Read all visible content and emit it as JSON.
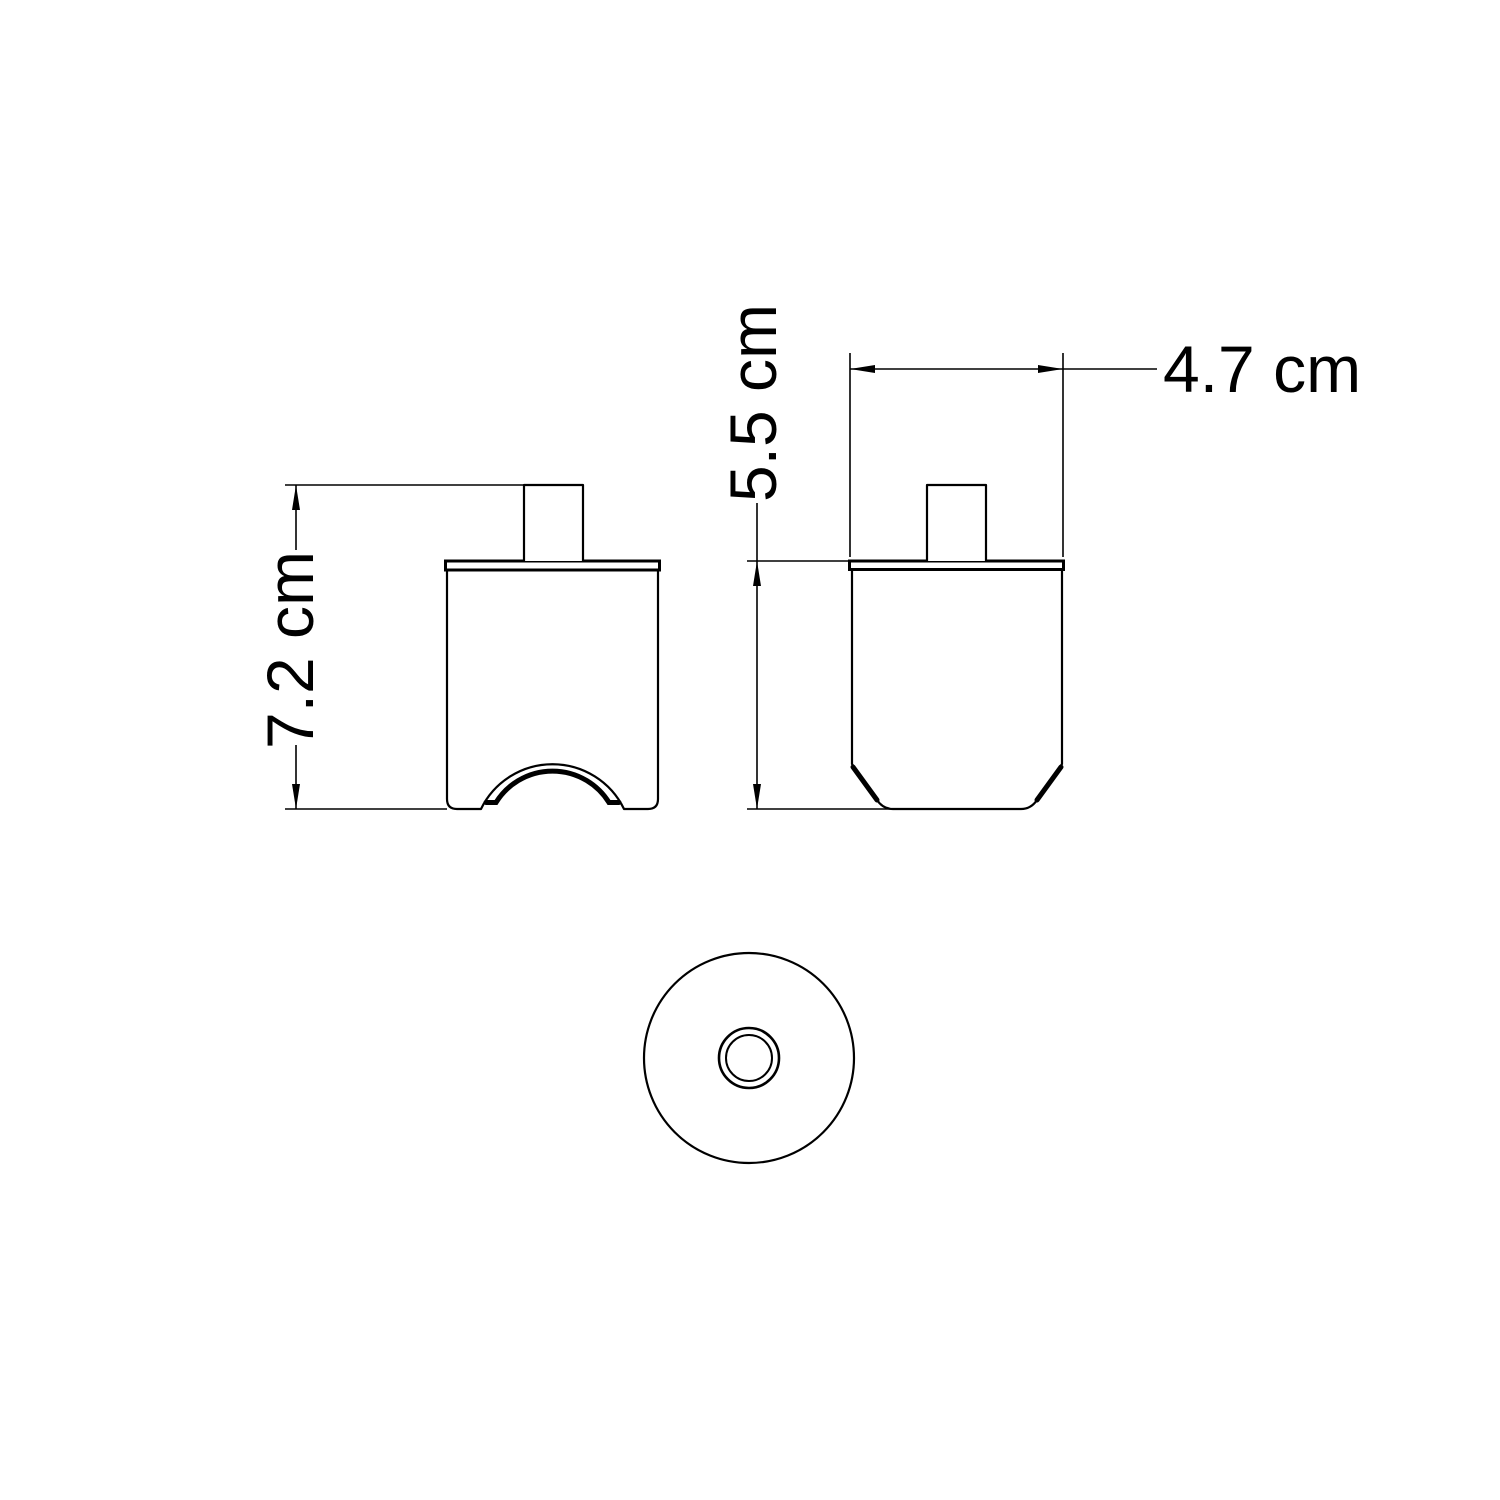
{
  "drawing": {
    "background_color": "#ffffff",
    "line_color": "#000000",
    "unit": "cm",
    "dimensions": {
      "front_height": {
        "label": "7.2 cm",
        "value": 7.2,
        "unit": "cm"
      },
      "side_height": {
        "label": "5.5 cm",
        "value": 5.5,
        "unit": "cm"
      },
      "side_width": {
        "label": "4.7 cm",
        "value": 4.7,
        "unit": "cm"
      }
    }
  }
}
